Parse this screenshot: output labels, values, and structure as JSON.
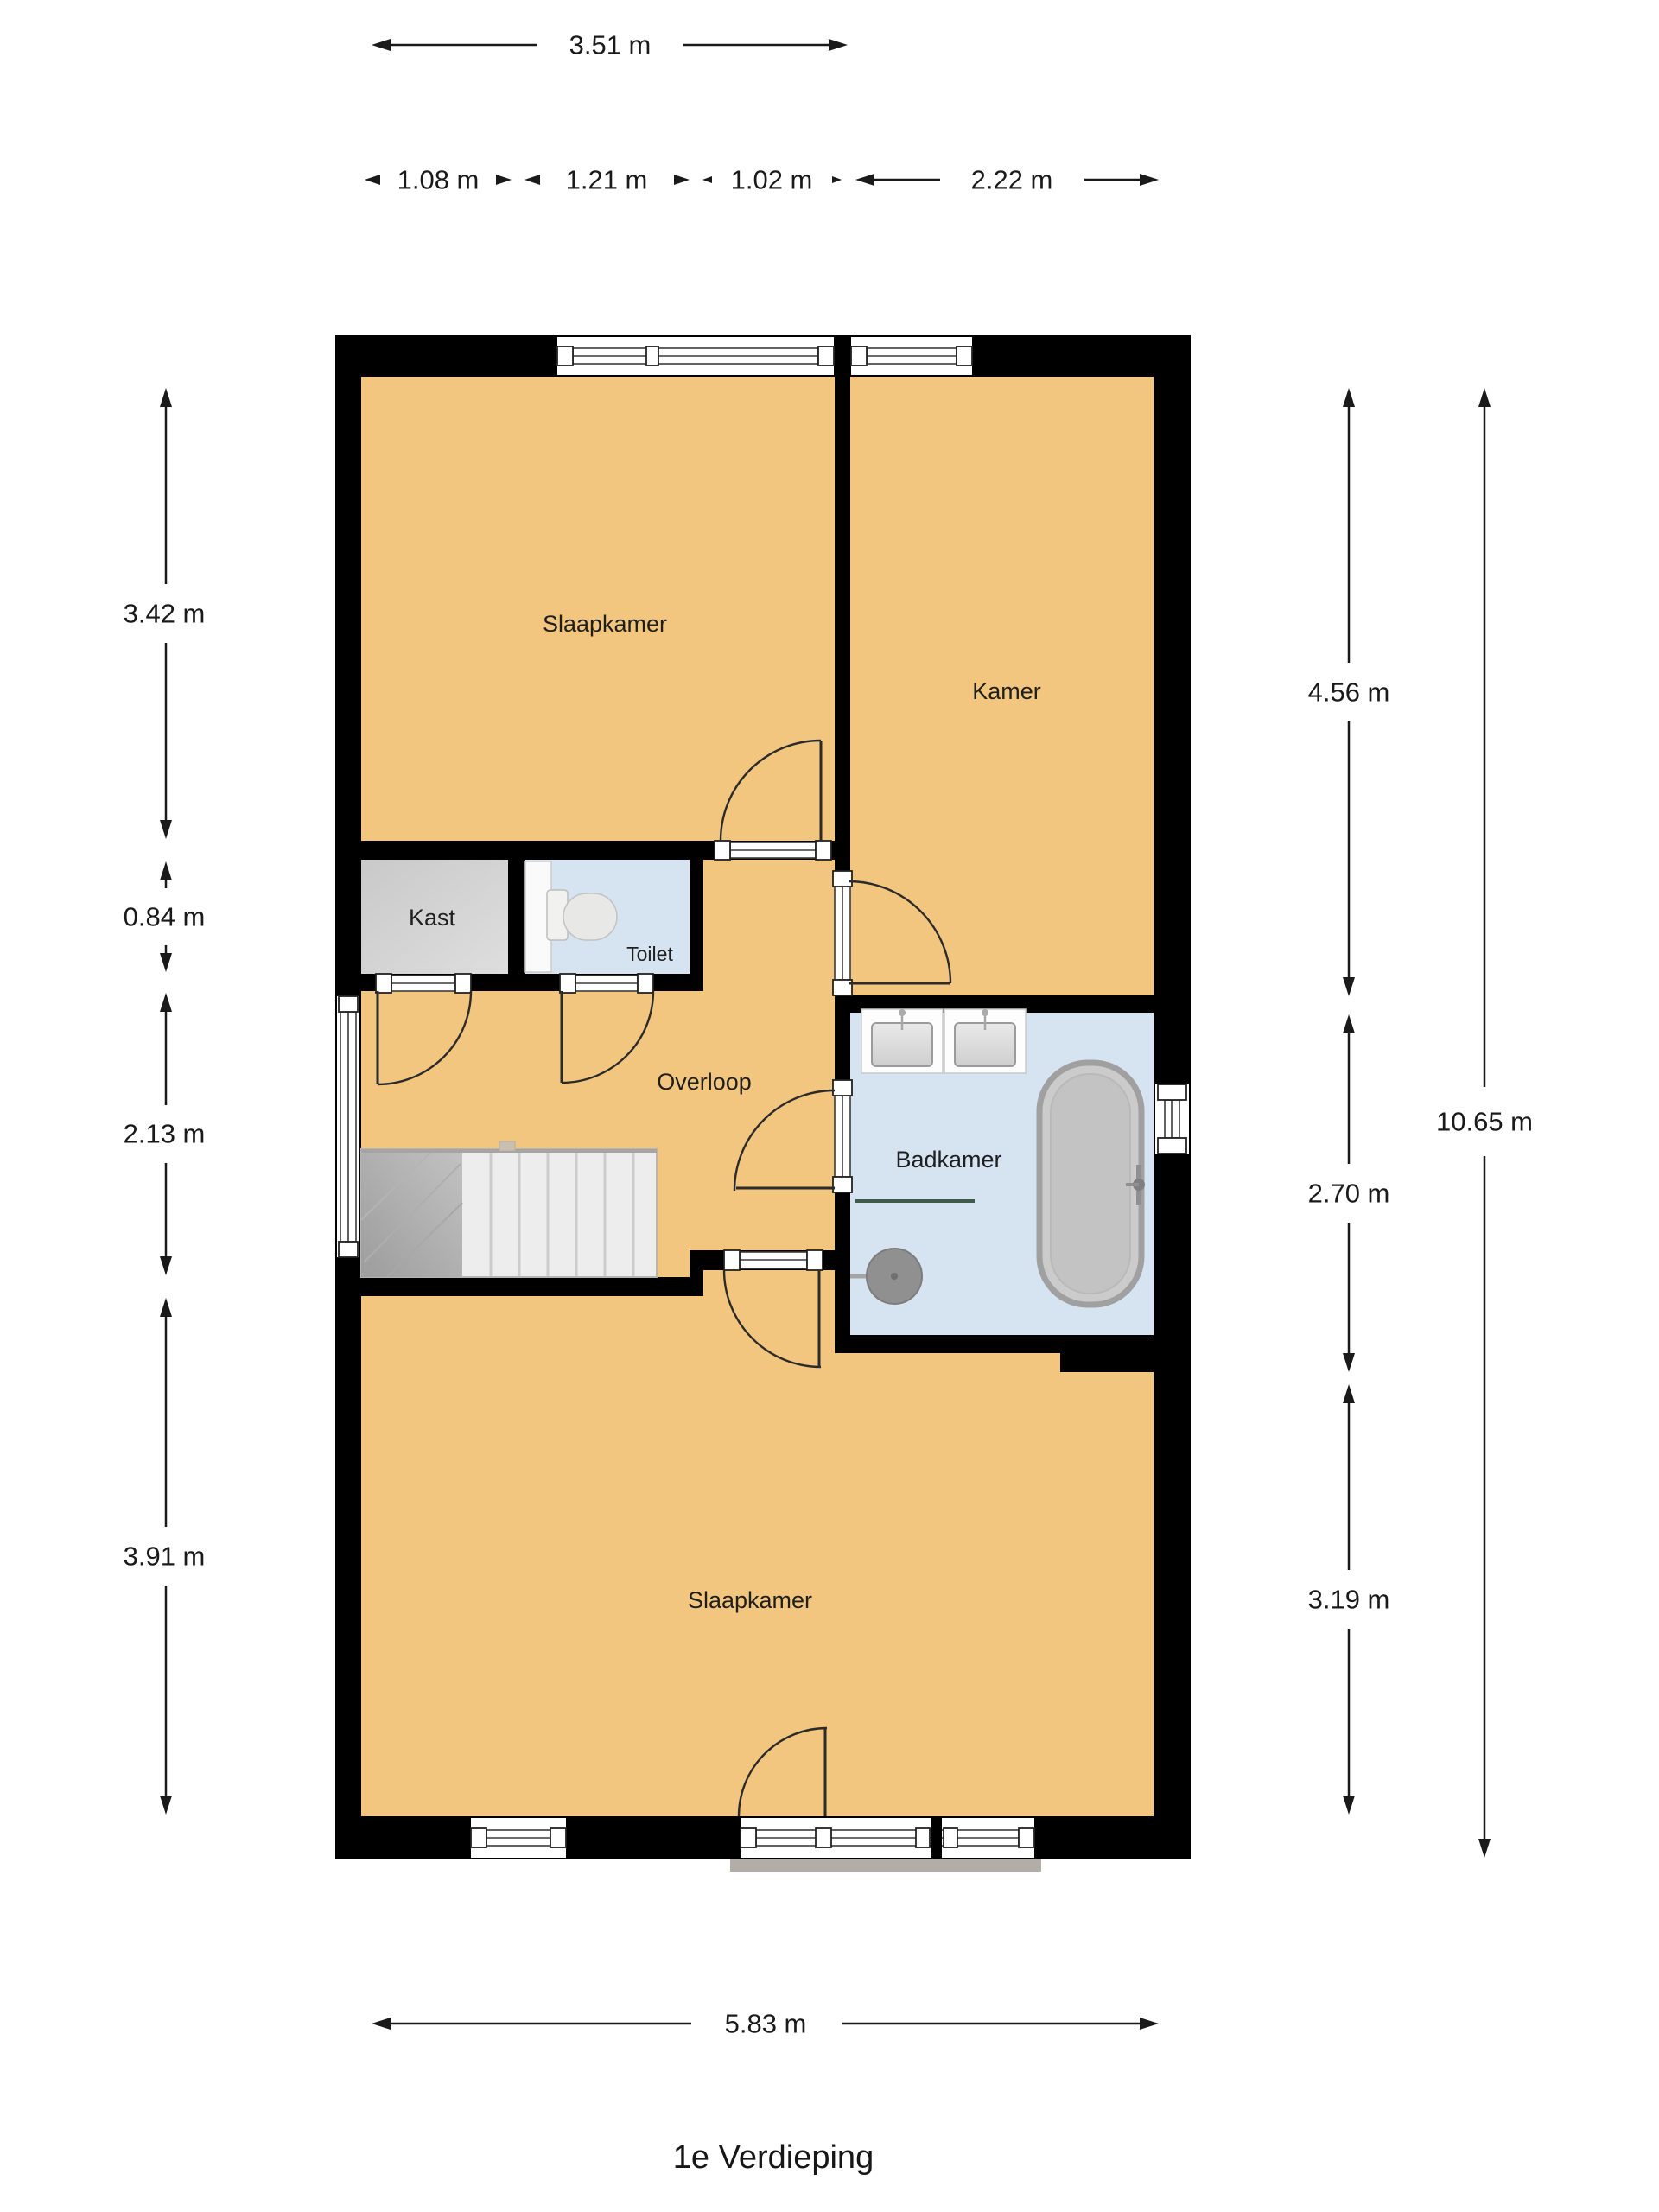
{
  "floorplan": {
    "title": "1e Verdieping",
    "rooms": {
      "slaapkamer_top": {
        "label": "Slaapkamer"
      },
      "kamer": {
        "label": "Kamer"
      },
      "kast": {
        "label": "Kast"
      },
      "toilet": {
        "label": "Toilet"
      },
      "overloop": {
        "label": "Overloop"
      },
      "badkamer": {
        "label": "Badkamer"
      },
      "slaapkamer_bottom": {
        "label": "Slaapkamer"
      }
    },
    "dimensions": {
      "top_width": "3.51 m",
      "segments": [
        "1.08 m",
        "1.21 m",
        "1.02 m",
        "2.22 m"
      ],
      "left": [
        "3.42 m",
        "0.84 m",
        "2.13 m",
        "3.91 m"
      ],
      "right": [
        "4.56 m",
        "2.70 m",
        "3.19 m"
      ],
      "right_total": "10.65 m",
      "bottom_width": "5.83 m"
    },
    "colors": {
      "floor": "#f2c67e",
      "wet_room": "#d6e3f1",
      "closet": "#d4d4d4",
      "wall": "#000000",
      "dimension_text": "#1a1a1a"
    }
  }
}
